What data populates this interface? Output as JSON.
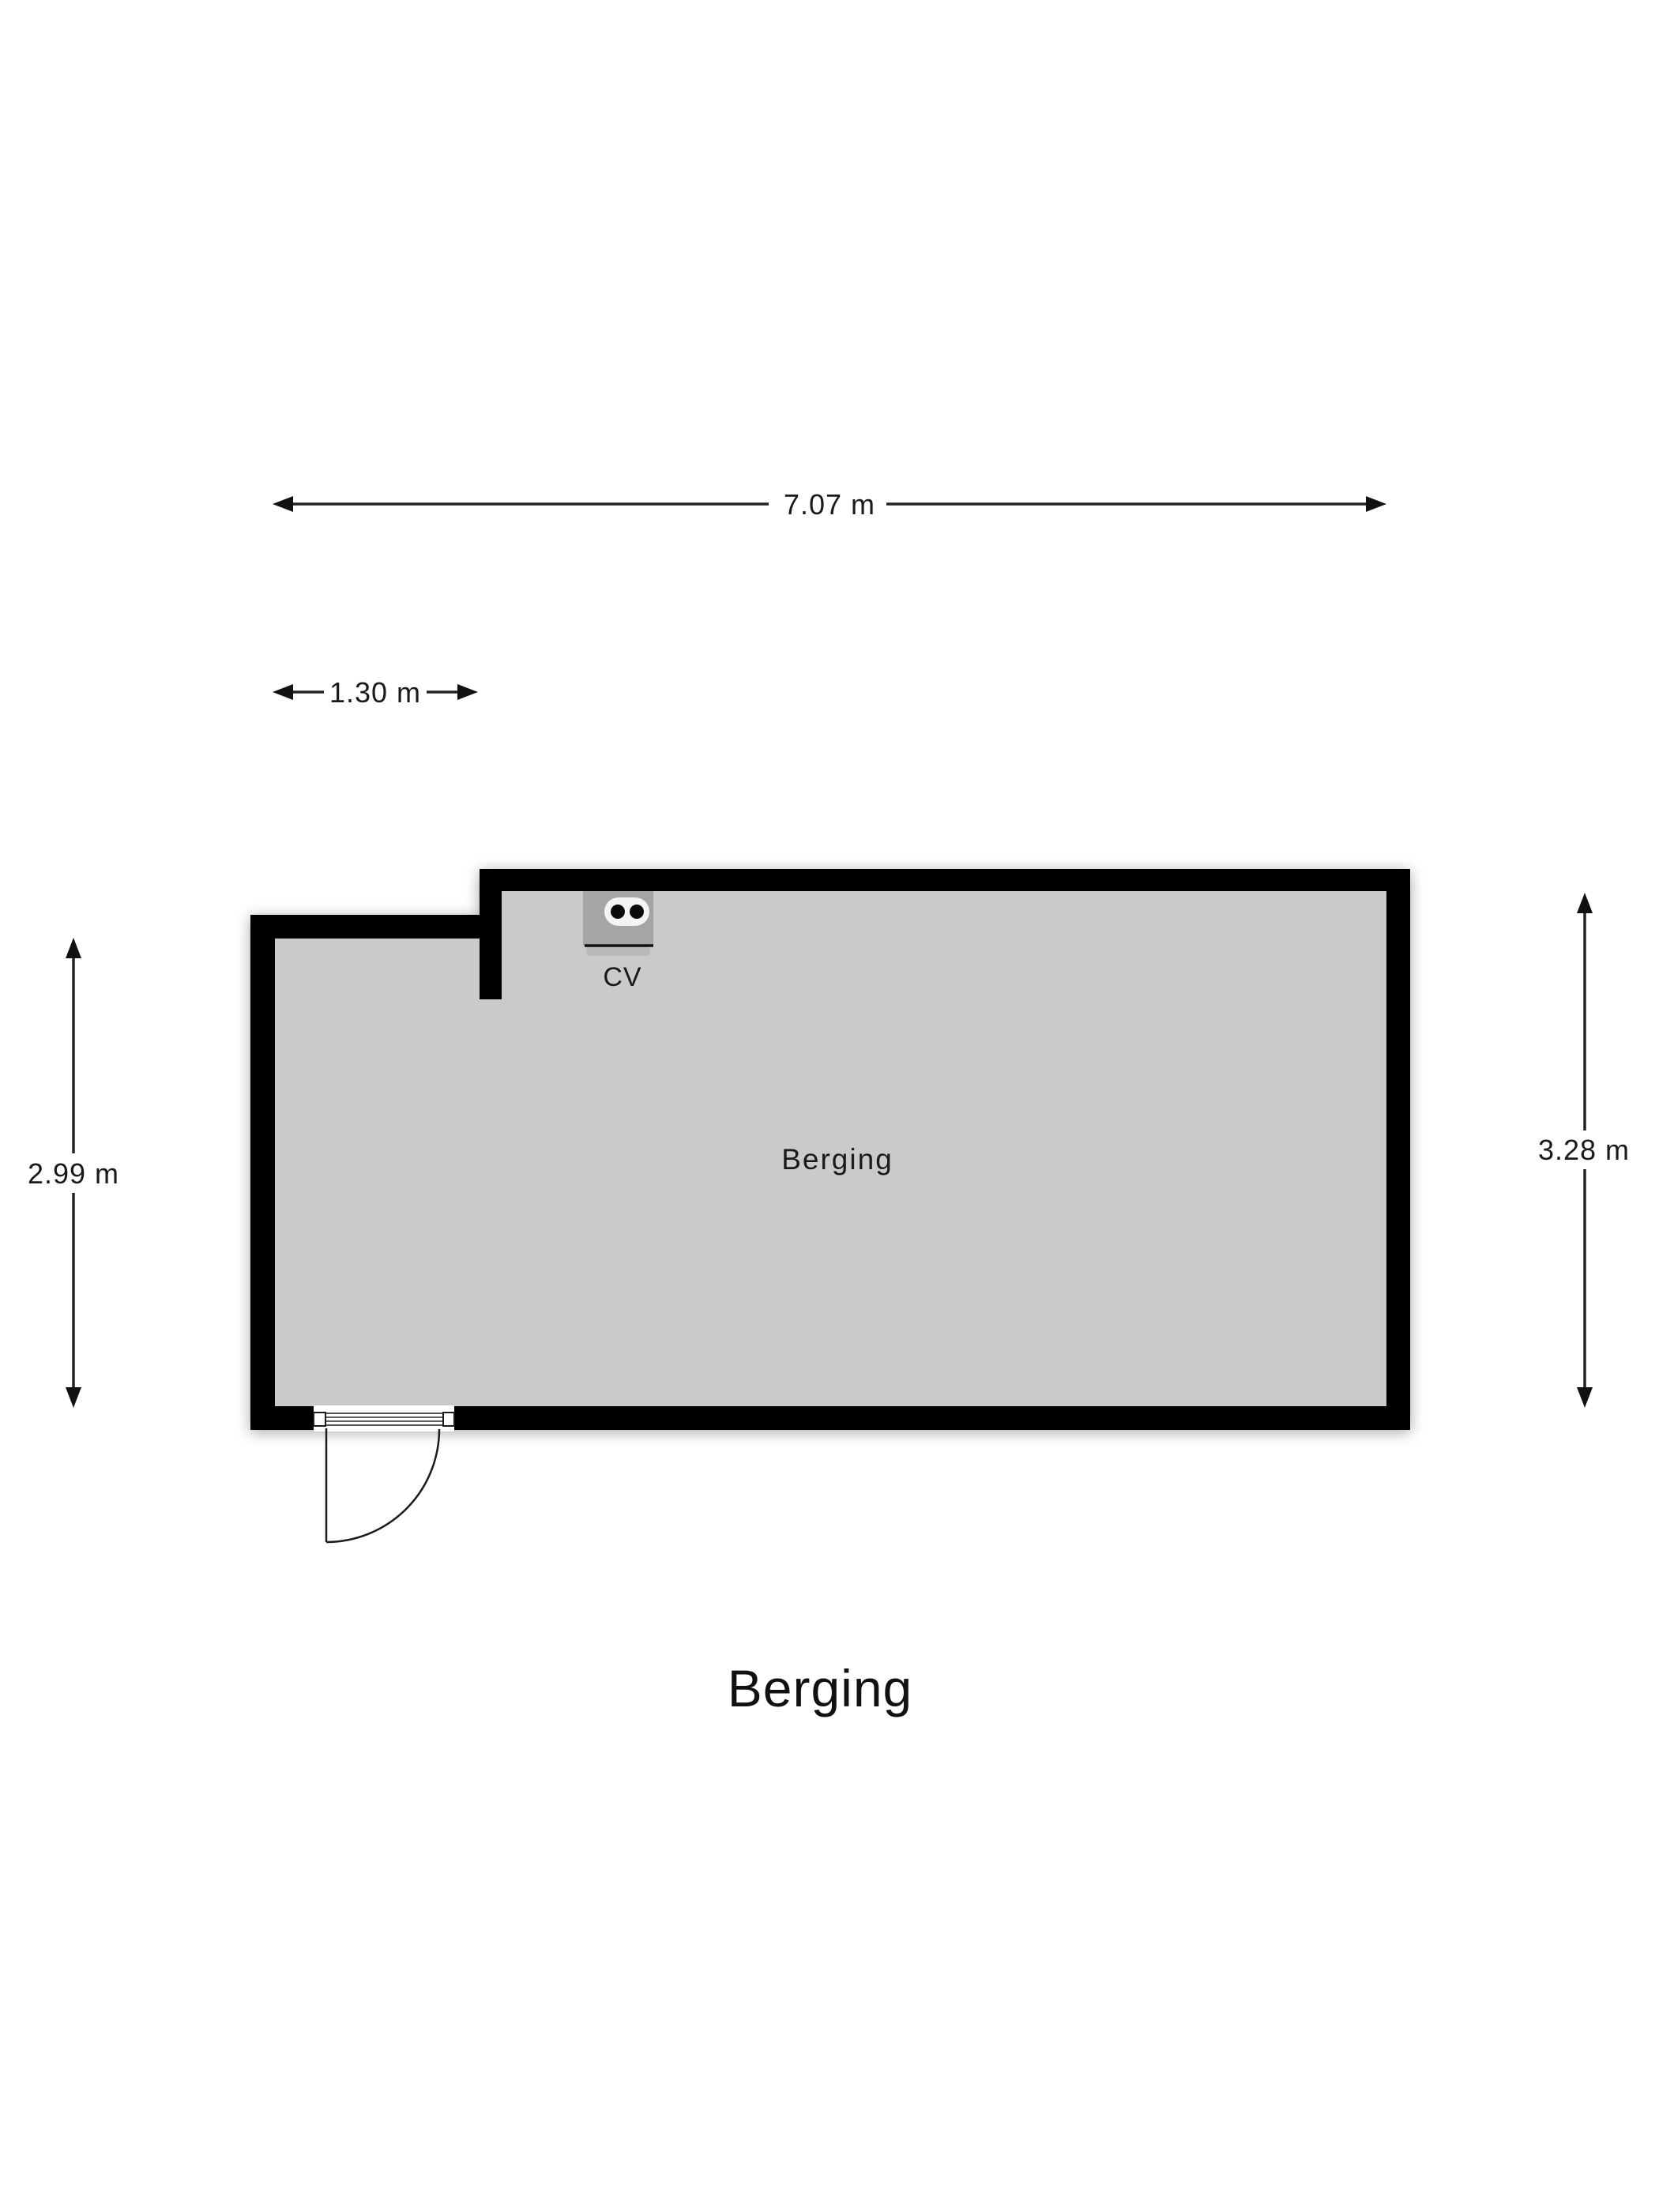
{
  "title": {
    "text": "Berging"
  },
  "room": {
    "label": "Berging"
  },
  "fixtures": {
    "cv_label": "CV"
  },
  "dimensions": {
    "top": {
      "label": "7.07 m"
    },
    "inner_left": {
      "label": "1.30 m"
    },
    "left": {
      "label": "2.99 m"
    },
    "right": {
      "label": "3.28 m"
    }
  },
  "colors": {
    "background": "#ffffff",
    "wall": "#000000",
    "floor": "#cacaca",
    "cv_unit": "#a5a5a5",
    "cv_unit_flap": "#b9b9b9",
    "cv_socket": "#f4f4f4",
    "text": "#1a1a1a",
    "dimension_line": "#222222"
  }
}
